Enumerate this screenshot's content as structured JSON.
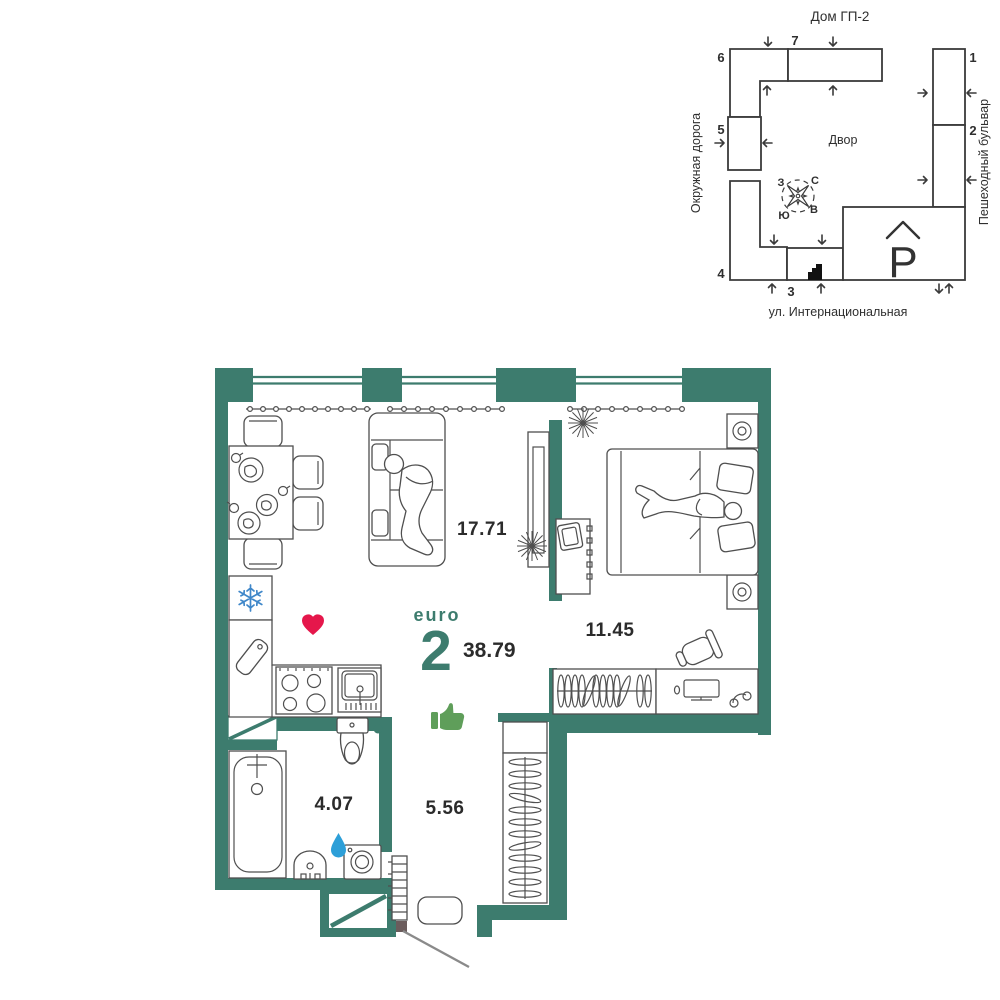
{
  "colors": {
    "wall": "#3d7c6e",
    "heart": "#e5174b",
    "thumb": "#5f9e5a",
    "snowflake": "#3f87c9",
    "water_drop": "#2d9fd8"
  },
  "site_map": {
    "title": "Дом ГП-2",
    "courtyard": "Двор",
    "street_left": "Окружная дорога",
    "street_right": "Пешеходный бульвар",
    "street_bottom": "ул. Интернациональная",
    "parking": "P",
    "compass": {
      "north": "С",
      "south": "Ю",
      "west": "З",
      "east": "В"
    },
    "buildings": [
      "1",
      "2",
      "3",
      "4",
      "5",
      "6",
      "7"
    ]
  },
  "plan": {
    "type_label": "euro",
    "rooms_count": "2",
    "total_area": "38.79",
    "areas": {
      "living_kitchen": "17.71",
      "bedroom": "11.45",
      "bathroom": "4.07",
      "hallway": "5.56"
    }
  }
}
